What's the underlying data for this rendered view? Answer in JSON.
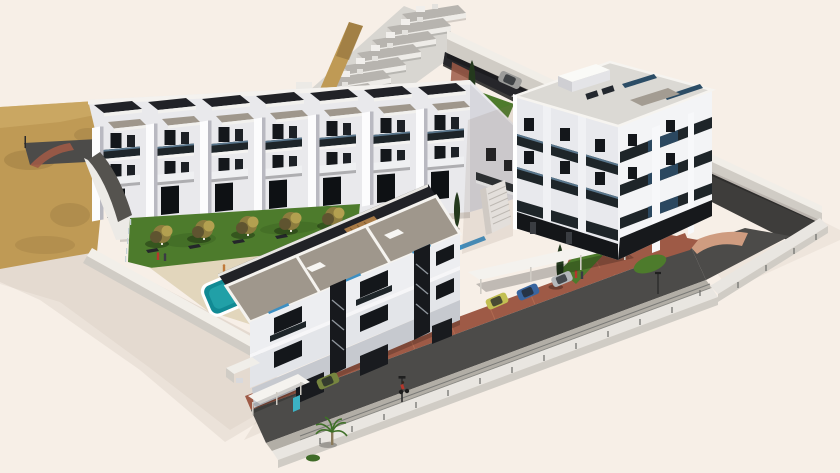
{
  "scene": {
    "alt": "Aerial 3D architectural rendering of a new-build residential development on a cream background: a long row of terraced townhouses, a stepped hillside terrace row behind, a four-storey apartment tower with dark balconies, low-rise two-storey apartments in front, a communal lawn with trees and a turquoise pool, sandy hillside to the left, and perimeter roads with fences, street lamps, parked cars and tiny people",
    "counts": {
      "townhouse_units": 7,
      "hillside_terrace_steps": 7,
      "tower_balcony_floors": 4,
      "lawn_trees": 5,
      "cypress_trees": 3,
      "cars": 6,
      "street_lamps": 3,
      "people": 6,
      "pools": 1
    }
  },
  "colors": {
    "bg": "#f7efe7",
    "shadow": "#8a7460",
    "sand": "#bf9a55",
    "sandDark": "#8f6f3a",
    "sandLight": "#d4b26d",
    "lawn": "#4d7b2c",
    "lawnDark": "#3c6322",
    "treeOlive": "#8c7c3e",
    "treeLight": "#b3a050",
    "treeDark": "#5f5430",
    "cypress": "#24391d",
    "pool": "#118a94",
    "poolLight": "#2fb3b6",
    "deck": "#e2d6bc",
    "roofTaupe": "#9f978c",
    "roofDark": "#212227",
    "white": "#f7f7f8",
    "wallShade": "#d8d8de",
    "win": "#14171b",
    "balc": "#1e2529",
    "glass": "#3d8fc2",
    "glassDark": "#2c4d66",
    "asphalt": "#4c4b49",
    "asphaltDark": "#3e3d3b",
    "paving": "#9e5a46",
    "pavingLight": "#b87156",
    "pavingPink": "#cf9c80",
    "sidewalk": "#b2aea6",
    "wallWhite": "#e9e6e1",
    "kerb": "#d0ccc5",
    "carYellow": "#c2bf52",
    "carBlue": "#39659f",
    "carSilver": "#b5b8bb",
    "vanGreen": "#76853f",
    "carRed": "#b03428",
    "carGray": "#9b9b99",
    "doorTeal": "#3cb2c4",
    "wood": "#a87a45",
    "figureRed": "#b5372c",
    "figureDark": "#3a3a44",
    "figureOrange": "#c07a3a",
    "metal": "#2b2b2b"
  }
}
